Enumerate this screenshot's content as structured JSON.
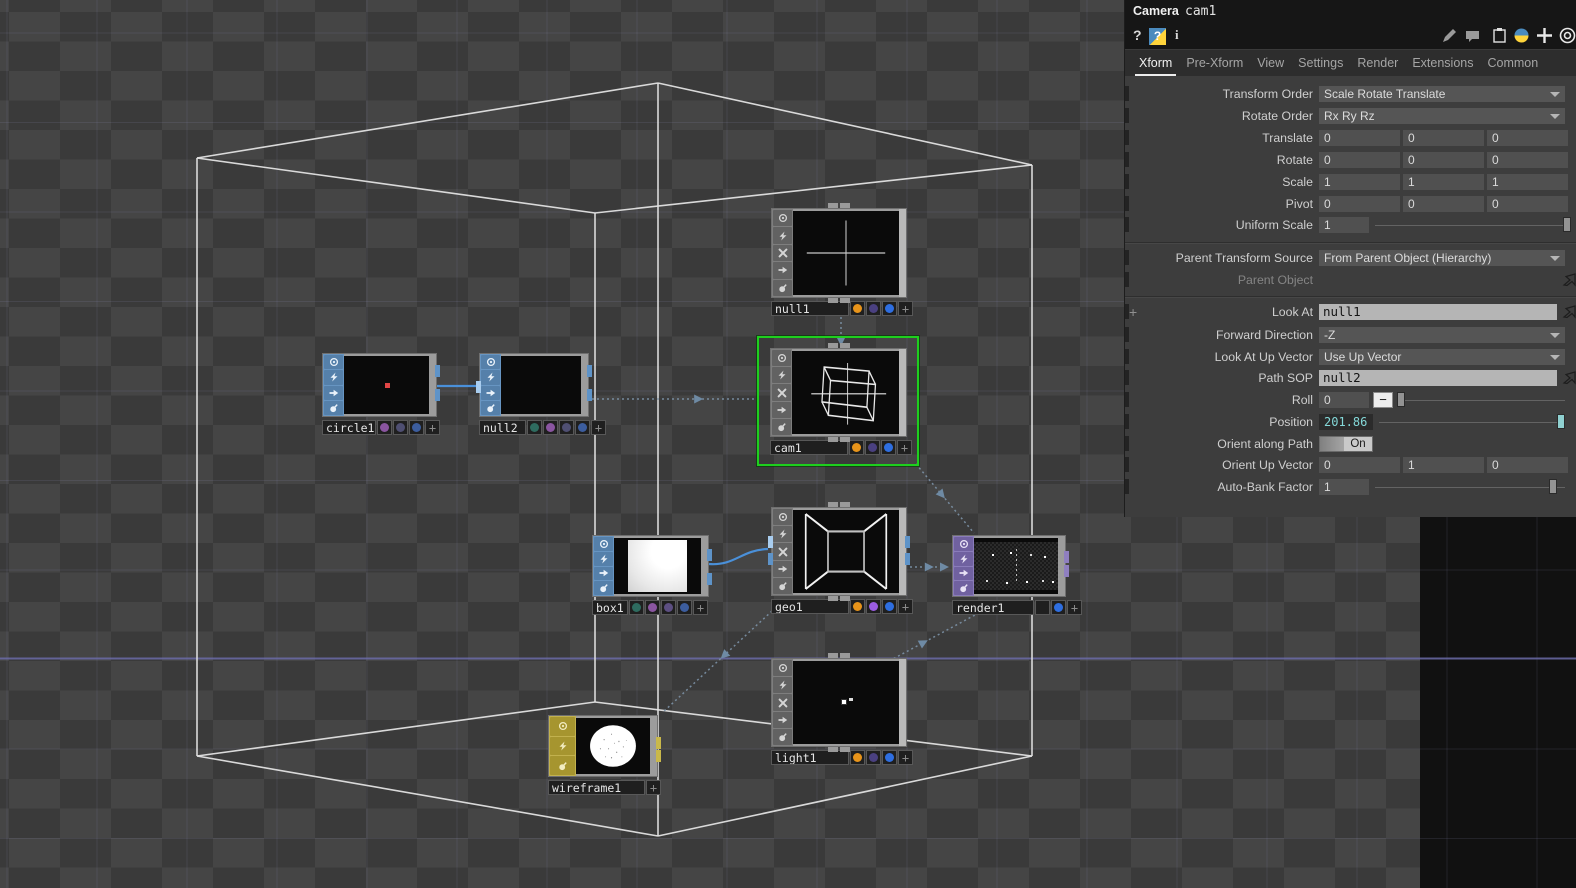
{
  "colors": {
    "selection_green": "#1ecf1e",
    "wire_blue": "#4a90d9",
    "reference_gray": "#7d93a8",
    "sop_blue": "#6795c2",
    "comp_gray": "#7e7e7e",
    "top_purple": "#8a7cba",
    "mat_yellow": "#c2b14e",
    "badge_orange": "#e8941a",
    "badge_blue": "#2e6ee0",
    "export_cyan": "#84d8d8",
    "axis_purple": "#6b6ba8"
  },
  "panel": {
    "header": {
      "type_label": "Camera",
      "name": "cam1"
    },
    "help_icons": [
      {
        "name": "help-question",
        "glyph": "?"
      },
      {
        "name": "python-help",
        "glyph": "?"
      },
      {
        "name": "info",
        "glyph": "i"
      }
    ],
    "toolbar_icons": [
      "pencil",
      "comment",
      "clipboard",
      "python",
      "plus",
      "target"
    ],
    "tabs": [
      {
        "label": "Xform",
        "active": true
      },
      {
        "label": "Pre-Xform",
        "active": false
      },
      {
        "label": "View",
        "active": false
      },
      {
        "label": "Settings",
        "active": false
      },
      {
        "label": "Render",
        "active": false
      },
      {
        "label": "Extensions",
        "active": false
      },
      {
        "label": "Common",
        "active": false
      }
    ],
    "rows": [
      {
        "label": "Transform Order",
        "type": "dropdown",
        "value": "Scale Rotate Translate"
      },
      {
        "label": "Rotate Order",
        "type": "dropdown",
        "value": "Rx Ry Rz"
      },
      {
        "label": "Translate",
        "type": "triple",
        "values": [
          "0",
          "0",
          "0"
        ]
      },
      {
        "label": "Rotate",
        "type": "triple",
        "values": [
          "0",
          "0",
          "0"
        ]
      },
      {
        "label": "Scale",
        "type": "triple",
        "values": [
          "1",
          "1",
          "1"
        ]
      },
      {
        "label": "Pivot",
        "type": "triple",
        "values": [
          "0",
          "0",
          "0"
        ]
      },
      {
        "label": "Uniform Scale",
        "type": "slider",
        "value": "1"
      },
      {
        "label": "Parent Transform Source",
        "type": "dropdown",
        "value": "From Parent Object (Hierarchy)"
      },
      {
        "label": "Parent Object",
        "type": "ref-empty",
        "value": "",
        "disabled": true
      },
      {
        "label": "Look At",
        "type": "ref",
        "value": "null1",
        "expand_plus": true
      },
      {
        "label": "Forward Direction",
        "type": "dropdown",
        "value": "-Z"
      },
      {
        "label": "Look At Up Vector",
        "type": "dropdown",
        "value": "Use Up Vector"
      },
      {
        "label": "Path SOP",
        "type": "ref",
        "value": "null2"
      },
      {
        "label": "Roll",
        "type": "slider-minus",
        "value": "0"
      },
      {
        "label": "Position",
        "type": "slider-cyan",
        "value": "201.86"
      },
      {
        "label": "Orient along Path",
        "type": "toggle",
        "value": "On"
      },
      {
        "label": "Orient Up Vector",
        "type": "triple",
        "values": [
          "0",
          "1",
          "0"
        ]
      },
      {
        "label": "Auto-Bank Factor",
        "type": "slider",
        "value": "1"
      }
    ]
  },
  "network": {
    "nodes": [
      {
        "name": "circle1",
        "family": "sop",
        "flags": [
          "viewer",
          "bypass",
          "arrow",
          "lock"
        ],
        "badges": [
          "#8a55a0",
          "#4f4f72",
          "#3c5d9e"
        ],
        "viewer": "reddot"
      },
      {
        "name": "null2",
        "family": "sop",
        "flags": [
          "viewer",
          "bypass",
          "arrow",
          "lock"
        ],
        "badges": [
          "#2e6b5f",
          "#8a55a0",
          "#4f4f72",
          "#3c5d9e"
        ],
        "viewer": "empty"
      },
      {
        "name": "box1",
        "family": "sop",
        "flags": [
          "viewer",
          "bypass",
          "arrow",
          "lock"
        ],
        "badges": [
          "#2e6b5f",
          "#8a55a0",
          "#5d4f82",
          "#3c5d9e"
        ],
        "viewer": "whitesquare"
      },
      {
        "name": "null1",
        "family": "comp",
        "flags": [
          "viewer",
          "bypass",
          "cross",
          "arrow",
          "lock"
        ],
        "badges": [
          "#e8941a",
          "#4a4080",
          "#2e6ee0"
        ],
        "viewer": "cross"
      },
      {
        "name": "cam1",
        "family": "comp",
        "flags": [
          "viewer",
          "bypass",
          "cross",
          "arrow",
          "lock"
        ],
        "badges": [
          "#e8941a",
          "#4a4080",
          "#2e6ee0"
        ],
        "viewer": "camcube",
        "selected": true
      },
      {
        "name": "geo1",
        "family": "comp",
        "flags": [
          "viewer",
          "bypass",
          "cross",
          "arrow",
          "lock"
        ],
        "badges": [
          "#e8941a",
          "#9a5ce0",
          "#2e6ee0"
        ],
        "viewer": "frustum"
      },
      {
        "name": "light1",
        "family": "comp",
        "flags": [
          "viewer",
          "bypass",
          "cross",
          "arrow",
          "lock"
        ],
        "badges": [
          "#e8941a",
          "#4a4080",
          "#2e6ee0"
        ],
        "viewer": "lightdots"
      },
      {
        "name": "render1",
        "family": "top",
        "flags": [
          "viewer",
          "bypass",
          "arrow",
          "lock"
        ],
        "badges": [
          "",
          "#2e6ee0"
        ],
        "viewer": "rendertex"
      },
      {
        "name": "wireframe1",
        "family": "mat",
        "flags": [
          "viewer",
          "bypass",
          "lock"
        ],
        "badges": [],
        "viewer": "sphere"
      }
    ],
    "wires": [
      {
        "from": "circle1",
        "to": "null2",
        "type": "data"
      },
      {
        "from": "box1",
        "to": "geo1",
        "type": "data"
      },
      {
        "from": "null2",
        "to": "cam1",
        "type": "reference"
      },
      {
        "from": "null1",
        "to": "cam1",
        "type": "reference"
      },
      {
        "from": "cam1",
        "to": "render1",
        "type": "reference"
      },
      {
        "from": "geo1",
        "to": "render1",
        "type": "reference"
      },
      {
        "from": "light1",
        "to": "render1",
        "type": "reference"
      },
      {
        "from": "geo1",
        "to": "wireframe1",
        "type": "reference"
      }
    ]
  }
}
